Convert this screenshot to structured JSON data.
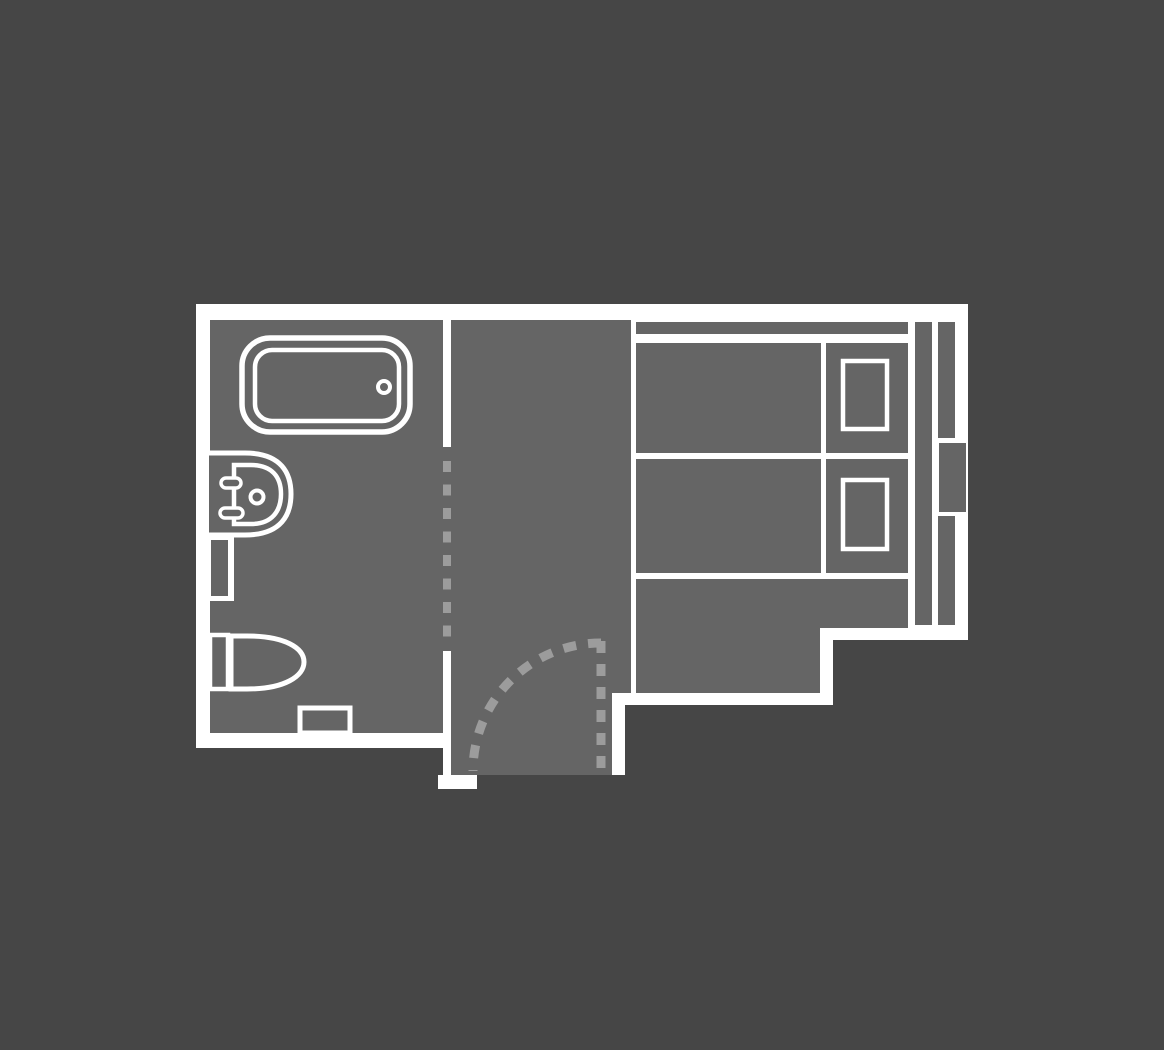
{
  "page": {
    "kind": "floor-plan-diagram",
    "subject": "hotel-room-floor-plan"
  },
  "colors": {
    "background": "#464646",
    "floor": "#656565",
    "wall": "#ffffff",
    "dash": "#9c9c9c"
  },
  "plan": {
    "areas": [
      "bathroom",
      "entry-hallway",
      "bedroom"
    ],
    "fixtures": [
      "bathtub",
      "bathtub-drain",
      "sink",
      "sink-basin",
      "faucet-handles",
      "sink-drain",
      "utility-shaft",
      "toilet-tank",
      "toilet-bowl",
      "bath-mat",
      "partition-opening-dashes",
      "entry-door-leaf",
      "entry-door-swing-arc",
      "headboard-shelf",
      "bed-1",
      "bed-1-pillow",
      "bed-2",
      "bed-2-pillow",
      "console-strip",
      "window-strip",
      "window-bay"
    ]
  }
}
